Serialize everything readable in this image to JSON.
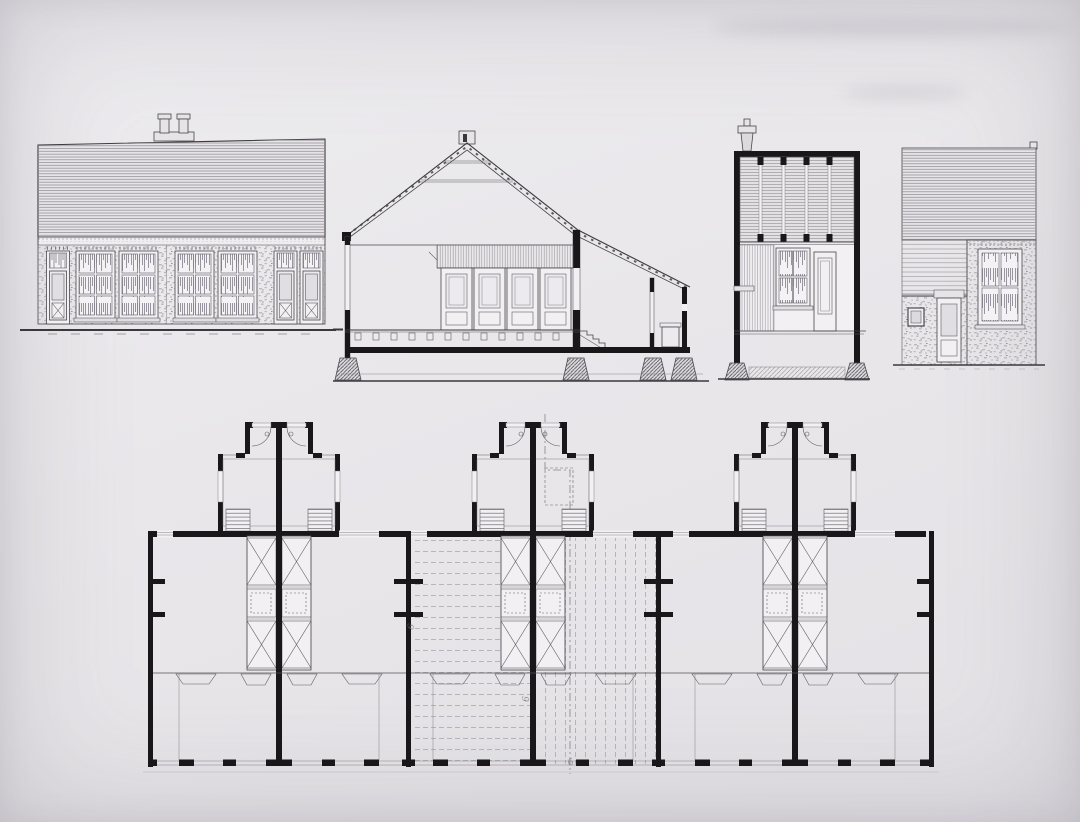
{
  "palette": {
    "paper": "#e9e7ea",
    "ink": "#1c1a1e",
    "line": "#4a474d",
    "faint_line": "#98959c",
    "texture": "#b1aeb4",
    "pencil": "#6f6c76"
  },
  "drawings": {
    "front_elevation": {
      "name": "front-elevation",
      "openings": 7,
      "chimneys": 2
    },
    "cross_section": {
      "name": "cross-section"
    },
    "longitudinal_section": {
      "name": "longitudinal-section"
    },
    "rear_elevation": {
      "name": "rear-elevation"
    },
    "floor_plan": {
      "name": "ground-floor-plan",
      "unit_pairs": 3
    }
  },
  "annotations": {
    "marks": [
      {
        "text": "6"
      },
      {
        "text": "6"
      },
      {
        "text": "6"
      }
    ]
  }
}
